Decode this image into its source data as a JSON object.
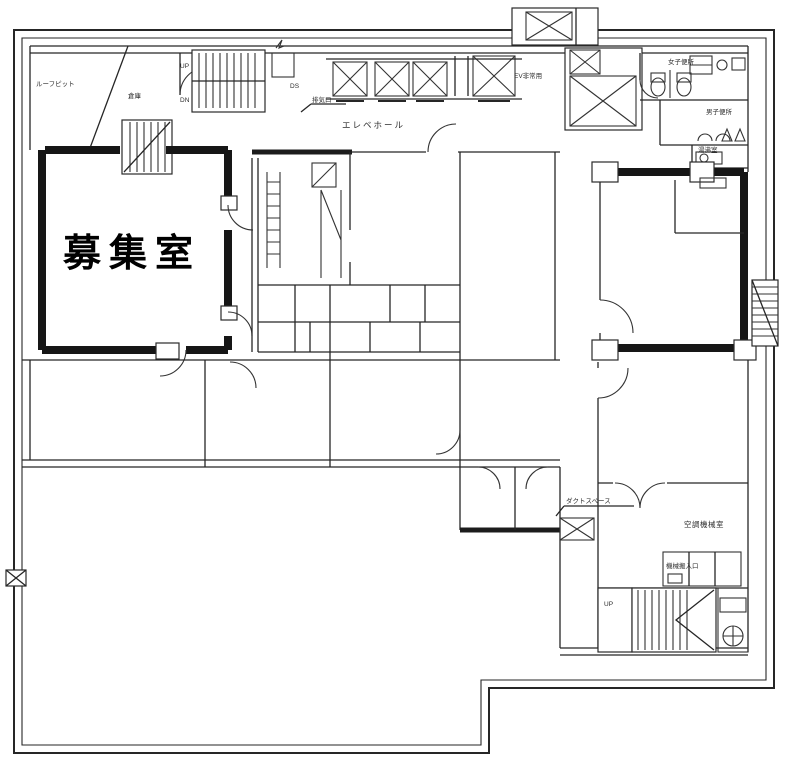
{
  "plan": {
    "labels": {
      "main_room": "募集室",
      "roof_pit": "ルーフピット",
      "storage": "倉庫",
      "duct_shaft": "DS",
      "exhaust_vent": "排気口",
      "elevator_hall": "エレベホール",
      "emergency_elevator": "EV非常用",
      "womens_toilet": "女子便所",
      "mens_toilet": "男子便所",
      "hot_water_room": "湯沸室",
      "duct_space": "ダクトスペース",
      "ac_machine_room": "空調機械室",
      "machine_entrance": "機械搬入口",
      "stair_up": "UP",
      "stair_down": "DN"
    },
    "colors": {
      "ink": "#262626",
      "paper": "#ffffff",
      "main_room_text": "#000000"
    }
  }
}
